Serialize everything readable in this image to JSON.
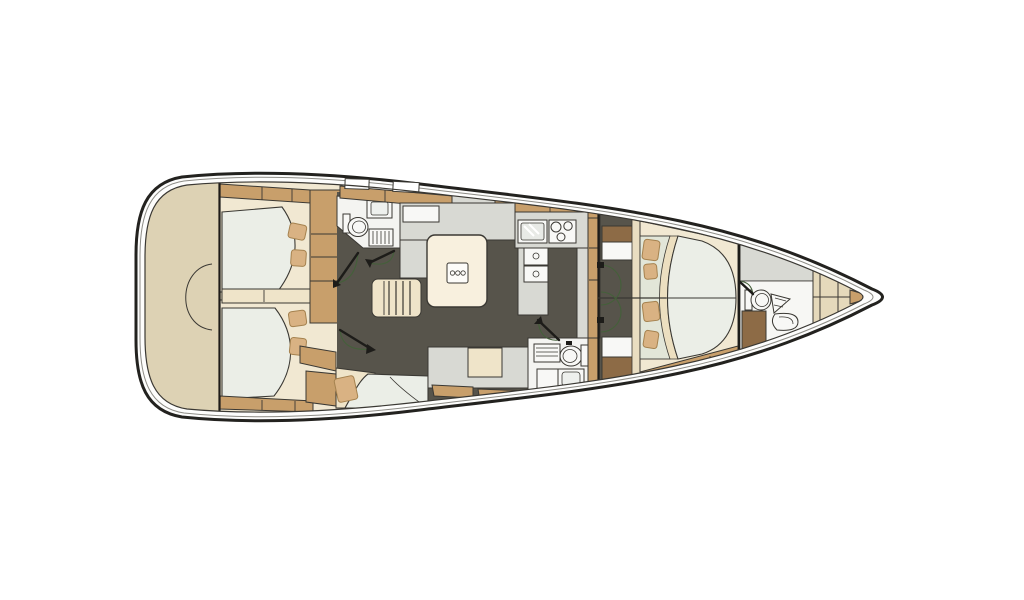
{
  "diagram": {
    "type": "yacht-interior-floor-plan",
    "orientation": "bow-right",
    "decks": 1,
    "rooms": [
      {
        "id": "transom",
        "label": "stern transom locker"
      },
      {
        "id": "port-aft-cabin",
        "label": "port aft double cabin"
      },
      {
        "id": "starboard-aft-cabin",
        "label": "starboard aft double cabin"
      },
      {
        "id": "port-aft-head",
        "label": "port aft head with toilet, sink and shower"
      },
      {
        "id": "salon",
        "label": "salon with dining table"
      },
      {
        "id": "companionway",
        "label": "companionway stairs"
      },
      {
        "id": "galley",
        "label": "galley with sink, stove and refrigerators"
      },
      {
        "id": "starboard-head",
        "label": "starboard head with toilet, sink and shower"
      },
      {
        "id": "nav-seating",
        "label": "navigation / seating area"
      },
      {
        "id": "forward-cabin",
        "label": "forward owner cabin with island berth"
      },
      {
        "id": "forward-head",
        "label": "forward head with toilet and sinks"
      },
      {
        "id": "bow-locker",
        "label": "anchor / sail locker"
      }
    ],
    "fixtures": [
      "double-berth",
      "pillows",
      "wardrobe",
      "dining-table",
      "stairs",
      "galley-sink",
      "stove-3-burner",
      "refrigerator",
      "toilet",
      "wash-basin",
      "shower-grate",
      "door-swing"
    ],
    "doors": 7,
    "berths": 3
  },
  "colors": {
    "bg": "#ffffff",
    "line": "#3a3833",
    "line-dark": "#1d1c19",
    "hull": "#23221f",
    "toe-rail": "#8d8c86",
    "deck": "#fdfdfc",
    "transom-beige": "#ddd2b4",
    "wood-tan": "#c89f6b",
    "wood-brown": "#8d6b46",
    "cabin-cream": "#f1e8d2",
    "bed-frame": "#efe4c9",
    "mattress": "#ebeee7",
    "pillow": "#d9b283",
    "pillow-line": "#a5824f",
    "floor": "#57544b",
    "counter": "#d8d9d3",
    "fixture": "#f8f8f6",
    "shelf": "#e2e6d8",
    "beige-wall": "#e5d9bb",
    "table": "#f8f0de",
    "door-arc": "#44603a",
    "hatch-line": "#8f8772"
  }
}
